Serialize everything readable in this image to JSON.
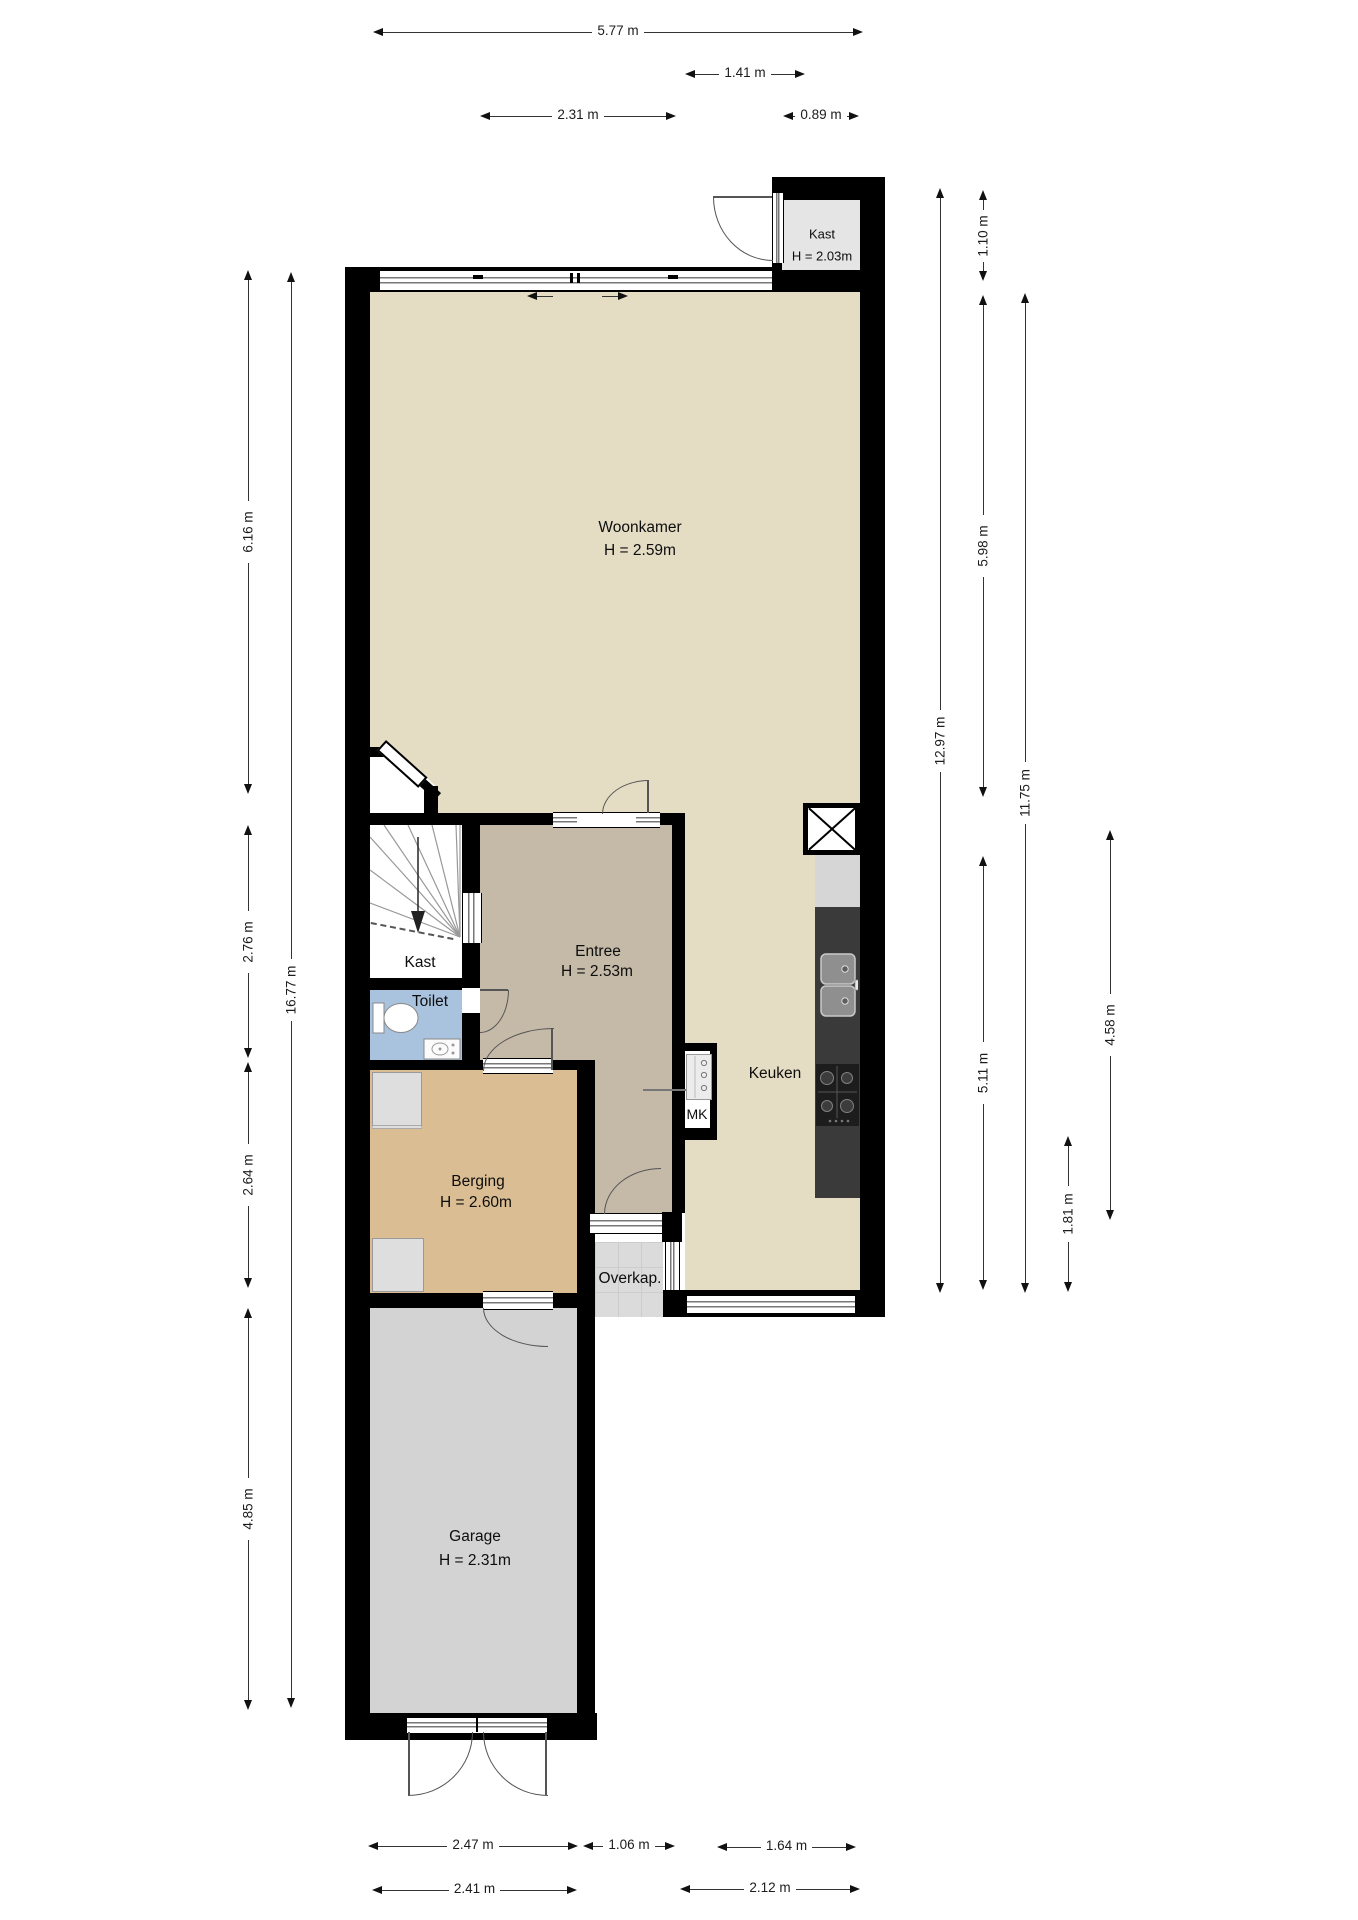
{
  "plan_title": "Begane grond plattegrond",
  "rooms": {
    "woonkamer": {
      "name": "Woonkamer",
      "height": "H = 2.59m"
    },
    "kast_boven": {
      "name": "Kast",
      "height": "H = 2.03m"
    },
    "entree": {
      "name": "Entree",
      "height": "H = 2.53m"
    },
    "kast_trap": {
      "name": "Kast"
    },
    "toilet": {
      "name": "Toilet"
    },
    "keuken": {
      "name": "Keuken"
    },
    "meterkast": {
      "name": "MK"
    },
    "berging": {
      "name": "Berging",
      "height": "H = 2.60m"
    },
    "overkap": {
      "name": "Overkap."
    },
    "garage": {
      "name": "Garage",
      "height": "H = 2.31m"
    }
  },
  "dimensions": {
    "top": [
      "5.77 m",
      "1.41 m",
      "2.31 m",
      "0.89 m"
    ],
    "bottom": [
      "2.47 m",
      "1.06 m",
      "1.64 m",
      "2.41 m",
      "2.12 m"
    ],
    "left": [
      "6.16 m",
      "2.76 m",
      "16.77 m",
      "2.64 m",
      "4.85 m"
    ],
    "right": [
      "1.10 m",
      "5.98 m",
      "12.97 m",
      "11.75 m",
      "5.11 m",
      "4.58 m",
      "1.81 m"
    ]
  },
  "colors": {
    "wall": "#000000",
    "woonkamer_floor": "#e4ddc4",
    "entree_floor": "#c5b9a8",
    "toilet_floor": "#a9c3de",
    "berging_floor": "#dabd93",
    "garage_floor": "#d3d3d3",
    "overkap_floor": "#dbdbdb",
    "kast_floor": "#e5e5e5",
    "counter": "#3a3a3a",
    "dimension_text": "#1c1c1c"
  }
}
